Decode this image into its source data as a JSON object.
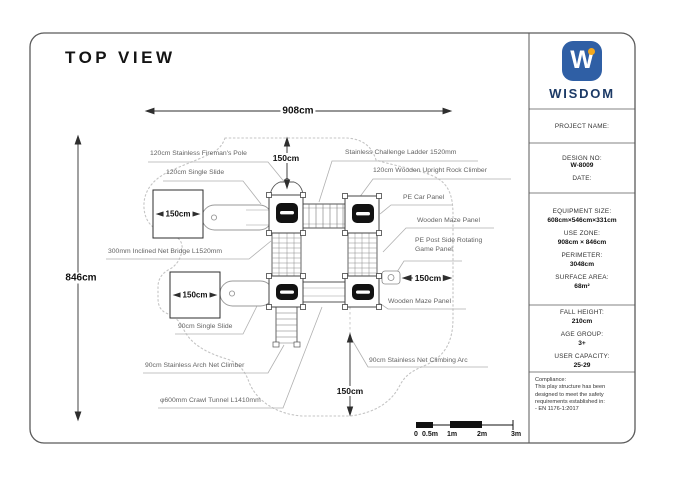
{
  "title": "TOP VIEW",
  "sidebar": {
    "brand": "WISDOM",
    "logo_letter": "W",
    "project_name_label": "PROJECT NAME:",
    "design_no_label": "DESIGN NO:",
    "design_no_value": "W-8009",
    "date_label": "DATE:",
    "specs": [
      {
        "label": "EQUIPMENT SIZE:",
        "value": "608cm×546cm×331cm"
      },
      {
        "label": "USE ZONE:",
        "value": "908cm × 846cm"
      },
      {
        "label": "PERIMETER:",
        "value": "3048cm"
      },
      {
        "label": "SURFACE AREA:",
        "value": "68m²"
      }
    ],
    "stats": [
      {
        "label": "FALL HEIGHT:",
        "value": "210cm"
      },
      {
        "label": "AGE GROUP:",
        "value": "3+"
      },
      {
        "label": "USER CAPACITY:",
        "value": "25-29"
      }
    ],
    "compliance": {
      "heading": "Compliance:",
      "body": "This play structure has been designed to meet the safety requirements established in:",
      "standard": "-   EN 1176-1:2017"
    }
  },
  "drawing": {
    "dims": {
      "width": "908cm",
      "height": "846cm",
      "top_gap": "150cm",
      "right_gap": "150cm",
      "bottom_gap": "150cm",
      "box_a": "150cm",
      "box_b": "150cm"
    },
    "labels": [
      "120cm Stainless Fireman's Pole",
      "120cm Single Slide",
      "Stainless Challenge Ladder 1520mm",
      "120cm Wooden Upright Rock Climber",
      "PE Car Panel",
      "Wooden Maze Panel",
      "PE Post Side Rotating Game Panel",
      "Wooden Maze Panel",
      "300mm Inclined Net Bridge L1520mm",
      "90cm Single Slide",
      "90cm Stainless Arch Net Climber",
      "90cm Stainless Net Climbing Arc",
      "φ600mm Crawl Tunnel L1410mm"
    ],
    "scalebar": [
      "0",
      "0.5m",
      "1m",
      "2m",
      "3m"
    ]
  },
  "colors": {
    "brand_blue": "#2f5fa5",
    "brand_orange": "#f2a71d",
    "brand_navy": "#1c3a66",
    "line_dark": "#444444",
    "line_light": "#b0b0b0",
    "zone_dotted": "#c4c4c4"
  }
}
